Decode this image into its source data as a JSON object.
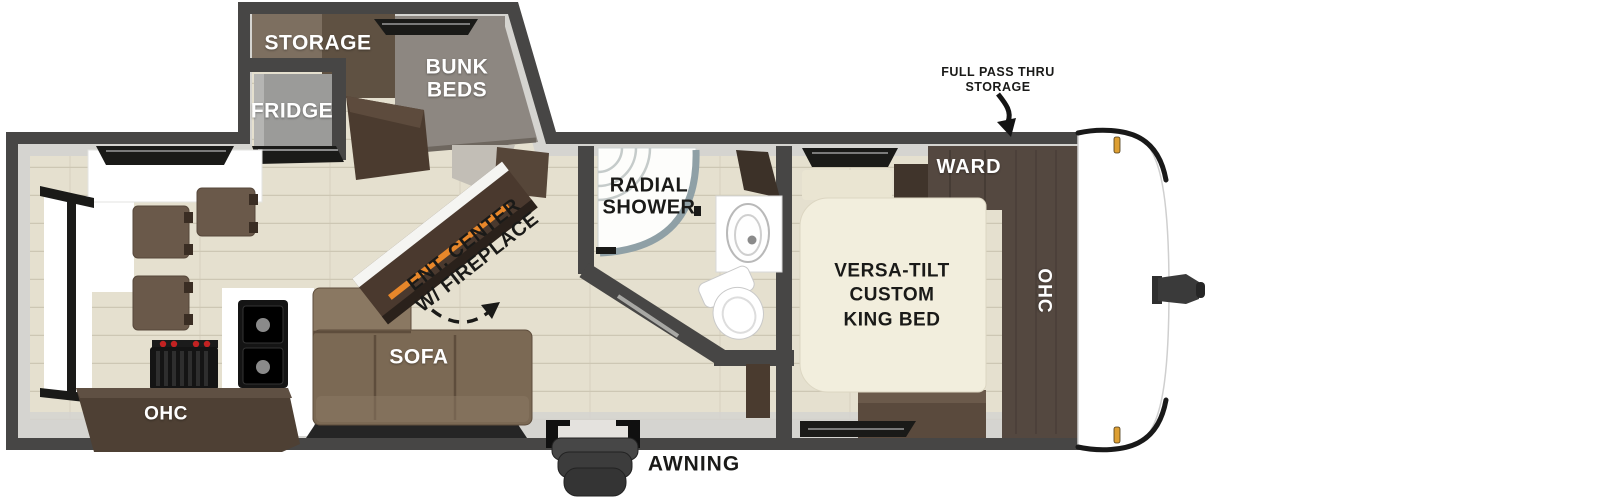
{
  "diagram_title": "Travel trailer floor plan",
  "bunk_room": {
    "storage": "STORAGE",
    "bunk_line1": "BUNK",
    "bunk_line2": "BEDS",
    "fridge": "FRIDGE"
  },
  "living": {
    "sofa": "SOFA",
    "ent_line1": "ENT. CENTER",
    "ent_line2": "W/ FIREPLACE"
  },
  "kitchen": {
    "ohc": "OHC"
  },
  "bathroom": {
    "shower_line1": "RADIAL",
    "shower_line2": "SHOWER"
  },
  "bedroom": {
    "bed_line1": "VERSA-TILT",
    "bed_line2": "CUSTOM",
    "bed_line3": "KING BED",
    "ward": "WARD",
    "ohc": "OHC"
  },
  "exterior": {
    "awning": "AWNING",
    "pass_thru_line1": "FULL PASS THRU",
    "pass_thru_line2": "STORAGE"
  },
  "colors": {
    "wall": "#474645",
    "lining": "#d5d4d0",
    "floor": "#e5e0cf",
    "floor_line": "#cdc7b4",
    "ink": "#1a1a18",
    "cab_dark": "#544840",
    "cab_mid": "#6a594a",
    "cab_light": "#7d6f60",
    "bunk_gray": "#8d8781",
    "sofa": "#7b6954",
    "sofa_light": "#8a7862",
    "mattress": "#f2eedd",
    "fire": "#e8872a",
    "amber": "#dd9f33",
    "fixture_rim": "#8fa0a6"
  }
}
